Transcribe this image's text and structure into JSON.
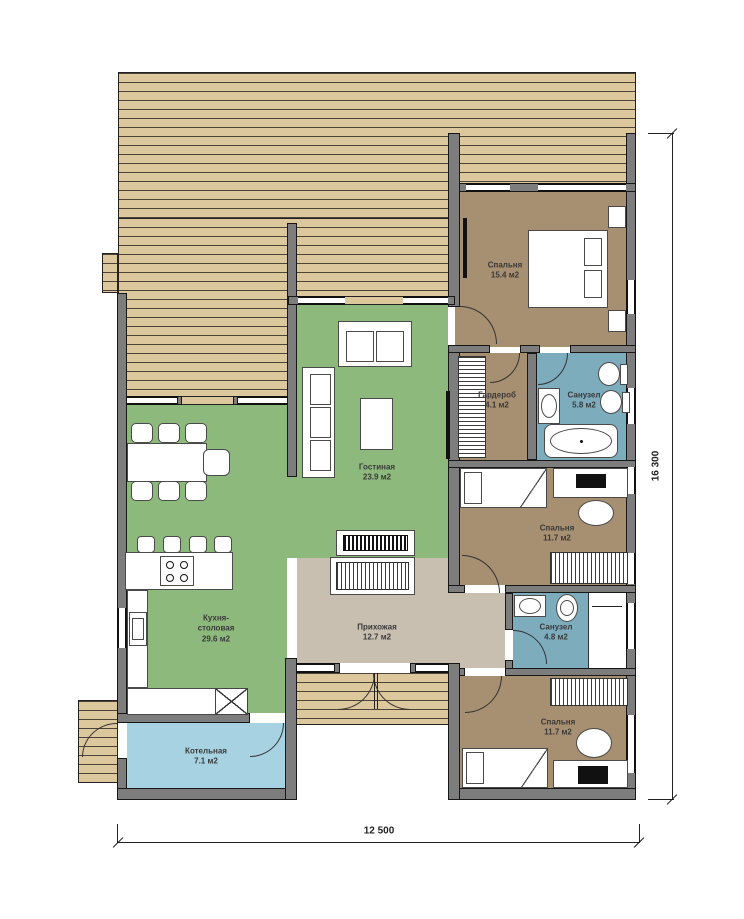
{
  "title": "Однокэтажный план дома",
  "colors": {
    "deck": "#dcc89c",
    "deckline": "#4a4338",
    "green": "#8eb97d",
    "brown": "#a78f71",
    "blue": "#7dacbd",
    "lightblue": "#a7d2e2",
    "beige": "#c8bfb1",
    "wall": "#7d7d7d",
    "labelcolor": "#3a3a3a"
  },
  "rooms": [
    {
      "name": "Спальня",
      "area": "15.4 м2"
    },
    {
      "name": "Гостиная",
      "area": "23.9 м2"
    },
    {
      "name": "Гардероб",
      "area": "4.1 м2"
    },
    {
      "name": "Санузел",
      "area": "5.8 м2"
    },
    {
      "name": "Спальня",
      "area": "11.7 м2"
    },
    {
      "name": "Кухня-столовая",
      "area": "29.6 м2"
    },
    {
      "name": "Прихожая",
      "area": "12.7 м2"
    },
    {
      "name": "Санузел",
      "area": "4.8 м2"
    },
    {
      "name": "Спальня",
      "area": "11.7 м2"
    },
    {
      "name": "Котельная",
      "area": "7.1 м2"
    }
  ],
  "dimensions": {
    "width": "12 500",
    "height": "16 300"
  }
}
